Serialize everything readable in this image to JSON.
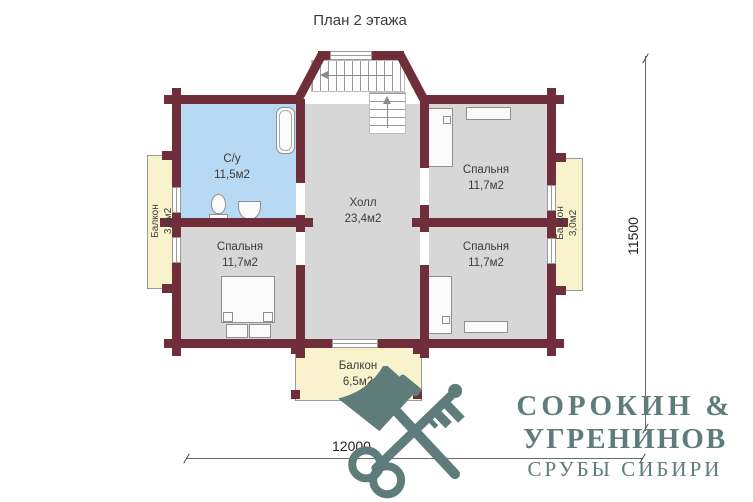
{
  "title": "План 2 этажа",
  "rooms": {
    "bathroom": {
      "name": "С/у",
      "area": "11,5м2"
    },
    "hall": {
      "name": "Холл",
      "area": "23,4м2"
    },
    "bedroom_top_right": {
      "name": "Спальня",
      "area": "11,7м2"
    },
    "bedroom_bottom_left": {
      "name": "Спальня",
      "area": "11,7м2"
    },
    "bedroom_bottom_right": {
      "name": "Спальня",
      "area": "11,7м2"
    },
    "balcony_left": {
      "name": "Балкон",
      "area": "3,0м2"
    },
    "balcony_right": {
      "name": "Балкон",
      "area": "3,0м2"
    },
    "balcony_bottom": {
      "name": "Балкон",
      "area": "6,5м2"
    }
  },
  "dimensions": {
    "width": "12000",
    "height": "11500"
  },
  "logo": {
    "line1": "СОРОКИН &",
    "line2": "УГРЕНИНОВ",
    "line3": "СРУБЫ СИБИРИ",
    "icon": "axe-key-crossed-icon"
  },
  "colors": {
    "wall": "#6f2e3a",
    "bathroom_fill": "#b8d9f3",
    "room_fill": "#d8d7d7",
    "balcony_fill": "#f9f3cd",
    "logo": "#5e7c79"
  }
}
